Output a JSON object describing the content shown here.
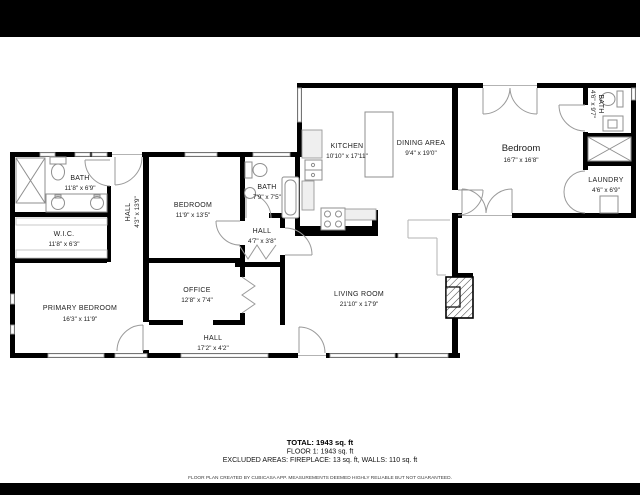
{
  "colors": {
    "wall": "#000000",
    "letterbox_bar": "#000000",
    "background": "#ffffff",
    "fixture_line": "#8f8f8f"
  },
  "rooms": [
    {
      "name": "BATH",
      "dims": "11'8\" x 6'9\""
    },
    {
      "name": "W.I.C.",
      "dims": "11'8\" x 6'3\""
    },
    {
      "name": "HALL",
      "dims": "4'3\" x 13'9\""
    },
    {
      "name": "PRIMARY BEDROOM",
      "dims": "16'3\" x 11'9\""
    },
    {
      "name": "BEDROOM",
      "dims": "11'9\" x 13'5\""
    },
    {
      "name": "BATH",
      "dims": "7'9\" x 7'5\""
    },
    {
      "name": "HALL",
      "dims": "4'7\" x 3'8\""
    },
    {
      "name": "OFFICE",
      "dims": "12'8\" x 7'4\""
    },
    {
      "name": "HALL",
      "dims": "17'2\" x 4'2\""
    },
    {
      "name": "KITCHEN",
      "dims": "10'10\" x 17'11\""
    },
    {
      "name": "DINING AREA",
      "dims": "9'4\" x 19'0\""
    },
    {
      "name": "LIVING ROOM",
      "dims": "21'10\" x 17'9\""
    },
    {
      "name": "Bedroom",
      "dims": "16'7\" x 16'8\""
    },
    {
      "name": "BATH",
      "dims": "4'6\" x 9'7\""
    },
    {
      "name": "LAUNDRY",
      "dims": "4'6\" x 6'9\""
    }
  ],
  "summary": {
    "total": "TOTAL: 1943 sq. ft",
    "floor": "FLOOR 1: 1943 sq. ft",
    "excluded": "EXCLUDED AREAS: FIREPLACE: 13 sq. ft, WALLS: 110 sq. ft",
    "disclaimer": "FLOOR PLAN CREATED BY CUBICASA APP. MEASUREMENTS DEEMED HIGHLY RELIABLE BUT NOT GUARANTEED."
  }
}
